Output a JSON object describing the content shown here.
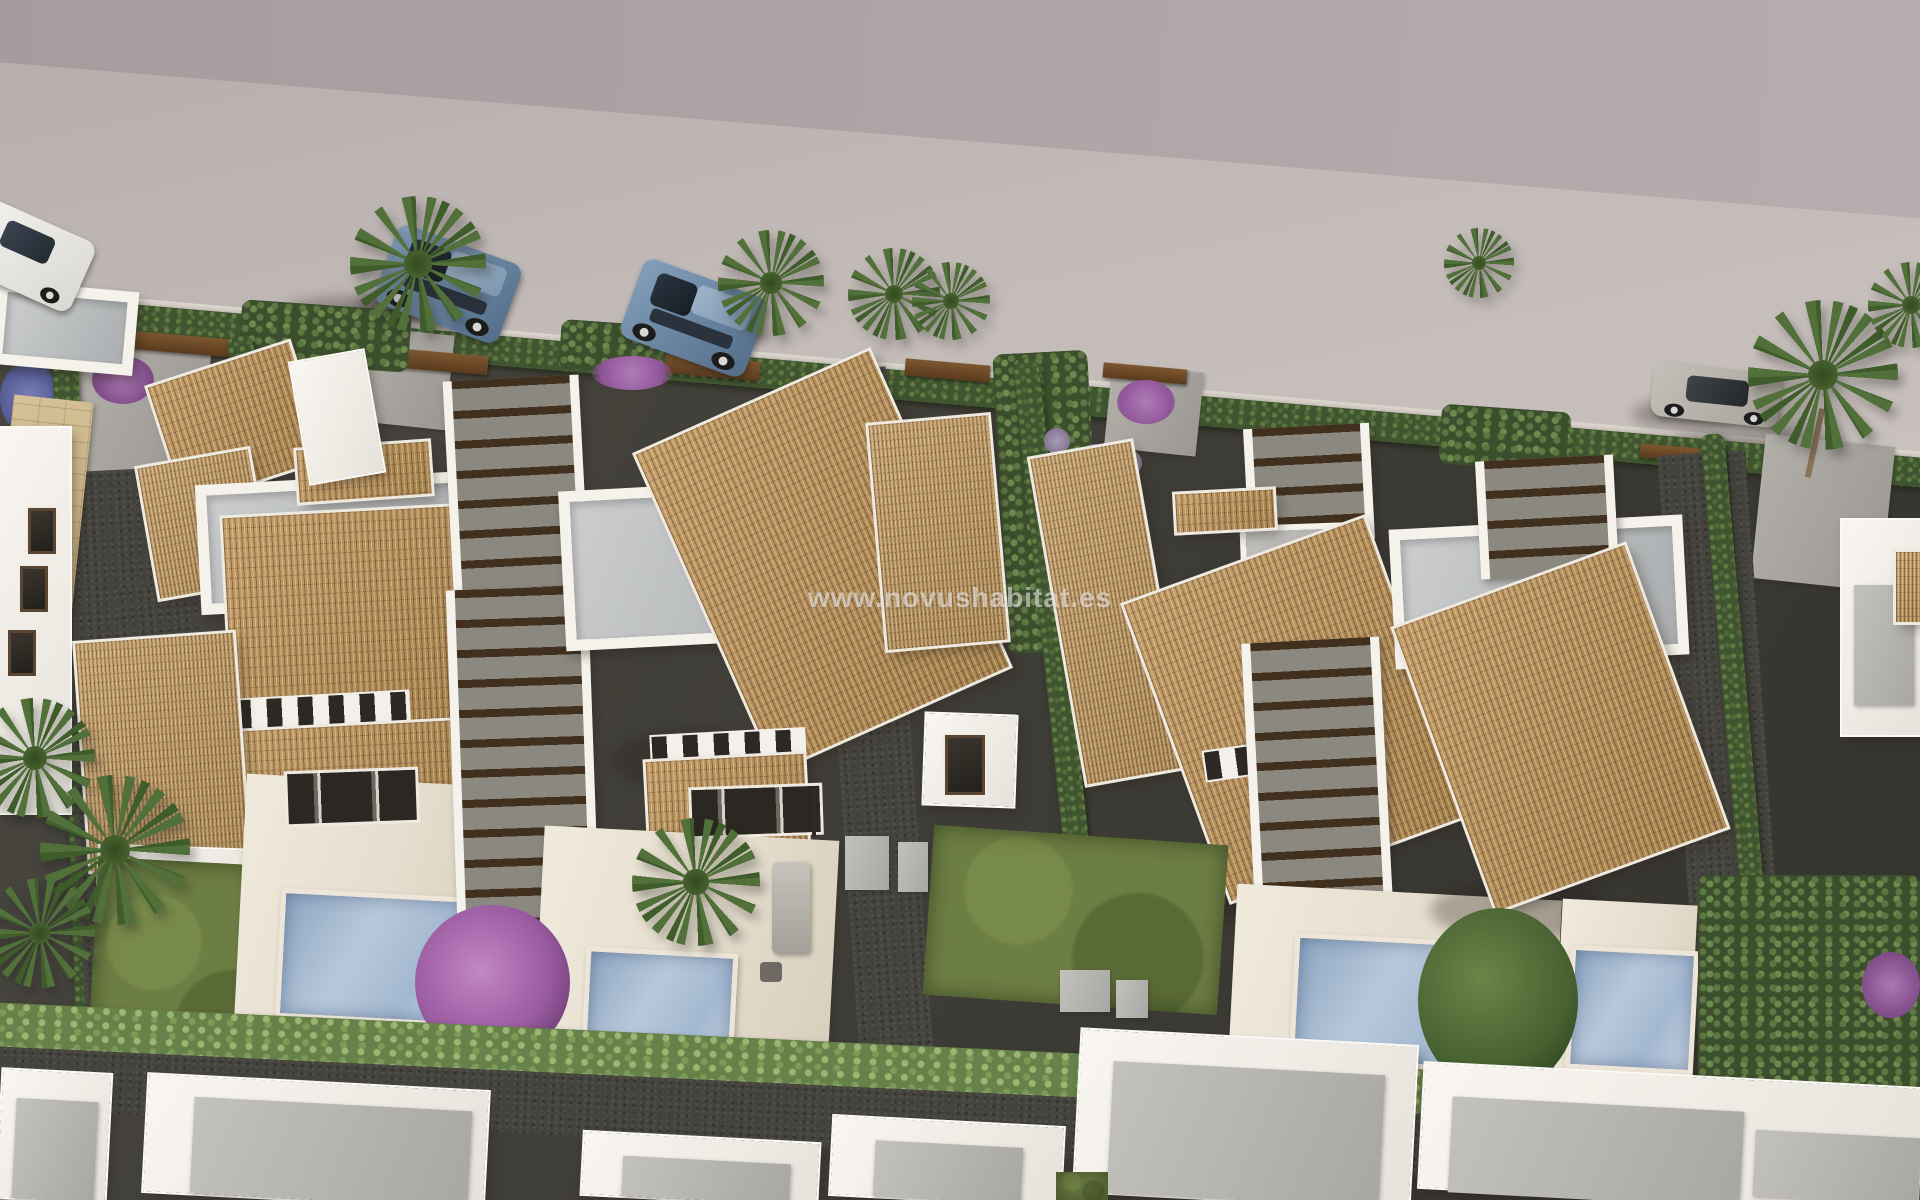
{
  "scene": {
    "description": "Aerial 3D architectural render of a Mediterranean villa development: white villas with terracotta barrel-tile roofs, wooden pergolas, private pools with timber decks, cypress hedges, palm trees and cars parked along a grey street at the top.",
    "watermark": "www.novushabitat.es"
  },
  "palette": {
    "street_upper": "#a59d9d",
    "street_lower": "#c8c0bc",
    "roof_tile": "#b6915d",
    "wall_white": "#f4f1eb",
    "terrace_floor": "#bdc0c2",
    "deck": "#e9e2d5",
    "pool_water": "#a4b9d2",
    "grass": "#6d7e44",
    "hedge_dark": "#3f5530",
    "hedge_light": "#66814a",
    "path_dark": "#45433d",
    "driveway": "#a7a49e",
    "pergola_slat": "#40301d",
    "corten_gate": "#6b4a28",
    "stone_wall": "#c9b48c",
    "bougainvillea": "#a569ad",
    "car_blue": "#7e99b4",
    "car_white": "#e9e8e4",
    "car_gray": "#b5afa9",
    "palm_green": "#51703a"
  },
  "objects": {
    "villas_visible": 4,
    "pools": 4,
    "palm_trees": 7,
    "cars": [
      {
        "color": "white",
        "position": "street far left"
      },
      {
        "color": "blue",
        "position": "street centre-left"
      },
      {
        "color": "blue",
        "position": "street centre"
      },
      {
        "color": "gray",
        "position": "street right"
      }
    ]
  }
}
